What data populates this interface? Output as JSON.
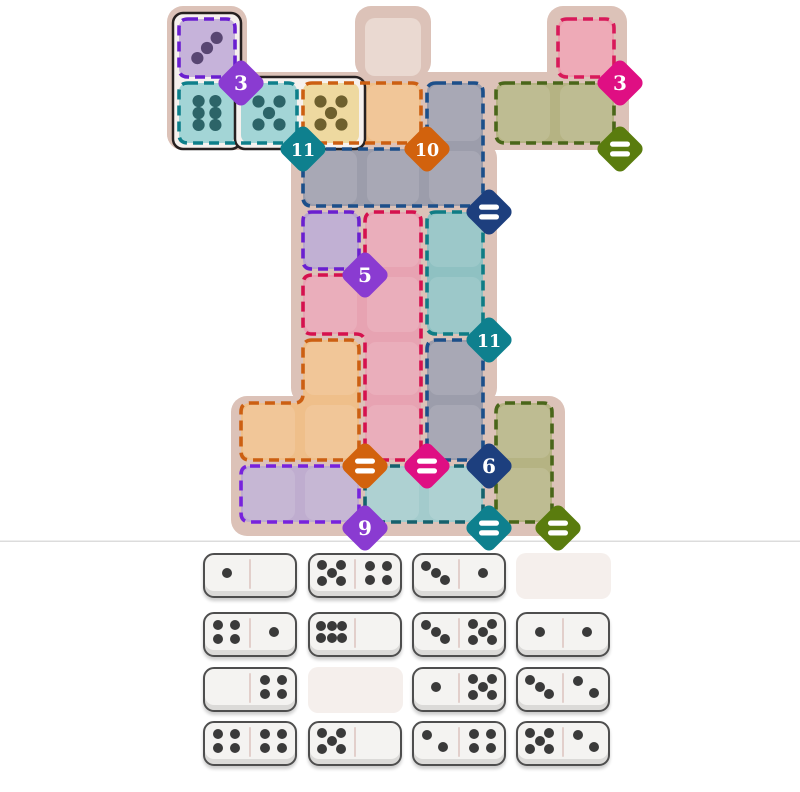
{
  "screen": {
    "name": "domino fit puzzle"
  },
  "palette": {
    "page_bg": "#ffffff",
    "board_bg": "#dcc2b8",
    "free_cell": "#ead9d1",
    "separator": "#dcdcdc",
    "domino_outline": "#262020",
    "domino_face": "#f6f1ee",
    "badge_text": "#ffffff",
    "tray_face": "#f4f3f1",
    "tray_border": "#4e4e4e",
    "tray_pip": "#3a3a3a",
    "tray_divider": "#e2cfcb",
    "empty_slot": "#f5efec"
  },
  "board": {
    "free_cells": [
      [
        "D",
        1
      ]
    ],
    "regions": [
      {
        "id": "purple-top",
        "cells": [
          [
            "A",
            1
          ]
        ],
        "fill": "#c6b3da",
        "stroke": "#6a1fd0",
        "badge": {
          "label": "3",
          "color": "#8a3bd1",
          "cell": [
            "A",
            1
          ]
        }
      },
      {
        "id": "teal-top",
        "cells": [
          [
            "A",
            2
          ],
          [
            "B",
            2
          ]
        ],
        "fill": "#a3d5d6",
        "stroke": "#0e7f8a",
        "badge": {
          "label": "11",
          "color": "#0e808e",
          "cell": [
            "B",
            2
          ]
        }
      },
      {
        "id": "orange-top",
        "cells": [
          [
            "C",
            2
          ],
          [
            "D",
            2
          ]
        ],
        "fill": "#efbf8a",
        "stroke": "#cc5f12",
        "badge": {
          "label": "10",
          "color": "#d2620d",
          "cell": [
            "D",
            2
          ]
        }
      },
      {
        "id": "pink-top",
        "cells": [
          [
            "G",
            1
          ]
        ],
        "fill": "#ec9fae",
        "stroke": "#d81a5a",
        "badge": {
          "label": "3",
          "color": "#df0f83",
          "cell": [
            "G",
            1
          ]
        }
      },
      {
        "id": "olive-top",
        "cells": [
          [
            "F",
            2
          ],
          [
            "G",
            2
          ]
        ],
        "fill": "#b5b383",
        "stroke": "#4a661a",
        "badge": {
          "label": "=",
          "color": "#5a7c0e",
          "cell": [
            "G",
            2
          ]
        }
      },
      {
        "id": "slate-upper",
        "cells": [
          [
            "E",
            2
          ],
          [
            "C",
            3
          ],
          [
            "D",
            3
          ],
          [
            "E",
            3
          ]
        ],
        "fill": "#9c9dab",
        "stroke": "#1c4f8a",
        "badge": {
          "label": "=",
          "color": "#1d3f7e",
          "cell": [
            "E",
            3
          ]
        }
      },
      {
        "id": "violet-mid",
        "cells": [
          [
            "C",
            4
          ]
        ],
        "fill": "#b9a6cd",
        "stroke": "#6a1fd0",
        "badge": {
          "label": "5",
          "color": "#8a3bd1",
          "cell": [
            "C",
            4
          ]
        }
      },
      {
        "id": "pink-mid",
        "cells": [
          [
            "D",
            4
          ],
          [
            "C",
            5
          ],
          [
            "D",
            5
          ],
          [
            "D",
            6
          ],
          [
            "D",
            7
          ]
        ],
        "fill": "#e7a3b2",
        "stroke": "#d5114e",
        "badge": {
          "label": "=",
          "color": "#df0f83",
          "cell": [
            "D",
            7
          ]
        }
      },
      {
        "id": "teal-mid",
        "cells": [
          [
            "E",
            4
          ],
          [
            "E",
            5
          ]
        ],
        "fill": "#8fc1c2",
        "stroke": "#0f7c85",
        "badge": {
          "label": "11",
          "color": "#0e808e",
          "cell": [
            "E",
            5
          ]
        }
      },
      {
        "id": "slate-lower",
        "cells": [
          [
            "E",
            6
          ],
          [
            "E",
            7
          ]
        ],
        "fill": "#9c9dab",
        "stroke": "#1c4f8a",
        "badge": {
          "label": "6",
          "color": "#1d3f7e",
          "cell": [
            "E",
            7
          ]
        }
      },
      {
        "id": "orange-lower",
        "cells": [
          [
            "C",
            6
          ],
          [
            "B",
            7
          ],
          [
            "C",
            7
          ]
        ],
        "fill": "#efbf8a",
        "stroke": "#cc5f12",
        "badge": {
          "label": "=",
          "color": "#d2620d",
          "cell": [
            "C",
            7
          ]
        }
      },
      {
        "id": "purple-bottom",
        "cells": [
          [
            "B",
            8
          ],
          [
            "C",
            8
          ]
        ],
        "fill": "#bfadcf",
        "stroke": "#7722dd",
        "badge": {
          "label": "9",
          "color": "#8a3bd1",
          "cell": [
            "C",
            8
          ]
        }
      },
      {
        "id": "teal-bottom",
        "cells": [
          [
            "D",
            8
          ],
          [
            "E",
            8
          ]
        ],
        "fill": "#a3cbcc",
        "stroke": "#15616d",
        "badge": {
          "label": "=",
          "color": "#0e808e",
          "cell": [
            "E",
            8
          ]
        }
      },
      {
        "id": "olive-bottom",
        "cells": [
          [
            "F",
            7
          ],
          [
            "F",
            8
          ]
        ],
        "fill": "#b5b383",
        "stroke": "#4a661a",
        "badge": {
          "label": "=",
          "color": "#5a7c0e",
          "cell": [
            "F",
            8
          ]
        }
      }
    ],
    "placed_dominoes": [
      {
        "orientation": "vertical",
        "cells": [
          [
            "A",
            1
          ],
          [
            "A",
            2
          ]
        ],
        "halves": [
          {
            "pips": 3,
            "layout": "3alt",
            "fill": "#c6b3da",
            "pip_color": "#584672"
          },
          {
            "pips": 6,
            "layout": "6v",
            "fill": "#a3d5d6",
            "pip_color": "#2c6468"
          }
        ]
      },
      {
        "orientation": "horizontal",
        "cells": [
          [
            "B",
            2
          ],
          [
            "C",
            2
          ]
        ],
        "halves": [
          {
            "pips": 5,
            "layout": "5",
            "fill": "#a3d5d6",
            "pip_color": "#2c6468"
          },
          {
            "pips": 5,
            "layout": "5",
            "fill": "#eed9a0",
            "pip_color": "#6e602e"
          }
        ]
      }
    ]
  },
  "tray": {
    "rows": [
      [
        {
          "left": 1,
          "right": 0
        },
        {
          "left": 5,
          "right": 4
        },
        {
          "left": 3,
          "right": 1
        },
        null
      ],
      [
        {
          "left": 4,
          "right": 1
        },
        {
          "left": 6,
          "right": 0
        },
        {
          "left": 3,
          "right": 5
        },
        {
          "left": 1,
          "right": 1
        }
      ],
      [
        {
          "left": 0,
          "right": 4
        },
        null,
        {
          "left": 1,
          "right": 5
        },
        {
          "left": 3,
          "right": 2
        }
      ],
      [
        {
          "left": 4,
          "right": 4
        },
        {
          "left": 5,
          "right": 0
        },
        {
          "left": 2,
          "right": 4
        },
        {
          "left": 5,
          "right": 2
        }
      ]
    ]
  }
}
